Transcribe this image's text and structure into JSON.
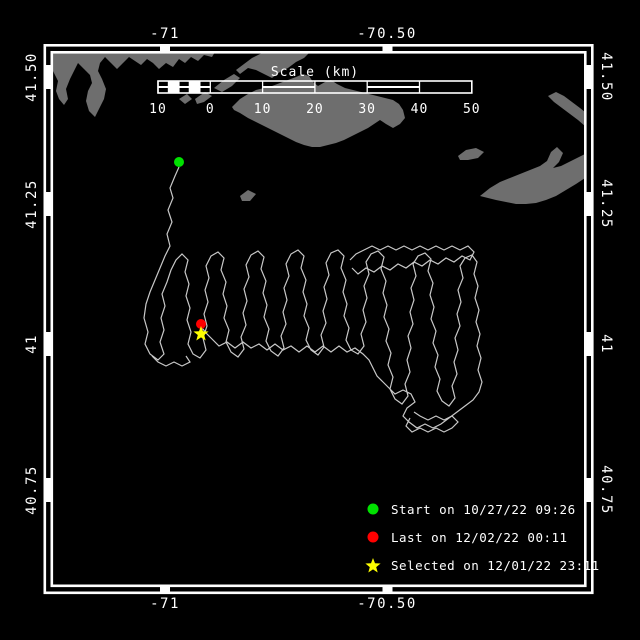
{
  "colors": {
    "background": "#000000",
    "frame": "#ffffff",
    "land": "#6e6e6e",
    "track": "#c8c8c8",
    "start": "#00e100",
    "last": "#ff0000",
    "selected": "#ffff00",
    "text": "#ffffff"
  },
  "axes": {
    "top": [
      "-71",
      "-70.50"
    ],
    "bottom": [
      "-71",
      "-70.50"
    ],
    "left": [
      "41.50",
      "41.25",
      "41",
      "40.75"
    ],
    "right": [
      "41.50",
      "41.25",
      "41",
      "40.75"
    ]
  },
  "legend": {
    "items": [
      {
        "icon": "circle",
        "color": "#00e100",
        "label": "Start on 10/27/22 09:26"
      },
      {
        "icon": "circle",
        "color": "#ff0000",
        "label": "Last on 12/02/22 00:11"
      },
      {
        "icon": "star",
        "color": "#ffff00",
        "label": "Selected on 12/01/22 23:11"
      }
    ]
  },
  "map": {
    "frame": {
      "lon_tick_x": [
        165,
        387.5
      ],
      "lat_tick_y": [
        77,
        204,
        344,
        490
      ]
    },
    "scalebar": {
      "title": "Scale (km)",
      "x0": 158,
      "y0": 81,
      "height": 12,
      "px_per_km": 5.23,
      "km_min": -10,
      "title_x": 315,
      "title_y": 76,
      "labels_y": 113,
      "segments": [
        [
          -10,
          -8,
          "mid"
        ],
        [
          -8,
          -6,
          "solid"
        ],
        [
          -6,
          -4,
          "mid"
        ],
        [
          -4,
          -2,
          "solid"
        ],
        [
          -2,
          0,
          "mid"
        ],
        [
          0,
          10,
          "open"
        ],
        [
          10,
          20,
          "mid"
        ],
        [
          20,
          30,
          "open"
        ],
        [
          30,
          40,
          "mid"
        ],
        [
          40,
          50,
          "open"
        ]
      ],
      "ticks": [
        [
          -10,
          "10"
        ],
        [
          0,
          "0"
        ],
        [
          10,
          "10"
        ],
        [
          20,
          "20"
        ],
        [
          30,
          "30"
        ],
        [
          40,
          "40"
        ],
        [
          50,
          "50"
        ]
      ]
    },
    "land": [
      [
        52,
        52,
        215,
        52,
        212,
        57,
        204,
        55,
        198,
        61,
        191,
        57,
        185,
        63,
        179,
        59,
        173,
        67,
        166,
        63,
        159,
        69,
        153,
        63,
        147,
        59,
        141,
        65,
        135,
        61,
        129,
        57,
        123,
        63,
        117,
        69,
        111,
        63,
        105,
        57,
        100,
        63,
        98,
        71,
        102,
        79,
        106,
        89,
        104,
        99,
        99,
        109,
        95,
        117,
        89,
        111,
        86,
        101,
        88,
        91,
        92,
        83,
        90,
        75,
        84,
        69,
        78,
        63,
        74,
        71,
        70,
        79,
        66,
        89,
        68,
        99,
        64,
        105,
        59,
        99,
        56,
        91,
        58,
        81,
        54,
        73,
        52,
        69
      ],
      [
        236,
        70,
        244,
        64,
        252,
        58,
        262,
        53,
        310,
        52,
        304,
        58,
        296,
        62,
        288,
        68,
        280,
        72,
        272,
        78,
        264,
        74,
        256,
        70,
        248,
        68,
        240,
        74
      ],
      [
        214,
        88,
        224,
        80,
        234,
        74,
        240,
        78,
        232,
        86,
        222,
        92
      ],
      [
        195,
        99,
        205,
        92,
        212,
        96,
        204,
        102,
        197,
        104
      ],
      [
        179,
        99,
        187,
        94,
        192,
        99,
        185,
        104
      ],
      [
        232,
        107,
        240,
        99,
        248,
        94,
        256,
        90,
        264,
        88,
        272,
        86,
        280,
        83,
        288,
        80,
        296,
        77,
        303,
        74,
        309,
        76,
        313,
        82,
        318,
        86,
        325,
        82,
        331,
        80,
        337,
        84,
        345,
        88,
        353,
        90,
        361,
        92,
        369,
        94,
        377,
        96,
        385,
        98,
        393,
        100,
        399,
        104,
        403,
        110,
        405,
        118,
        400,
        124,
        393,
        128,
        386,
        124,
        380,
        120,
        374,
        124,
        368,
        128,
        360,
        132,
        352,
        136,
        344,
        140,
        336,
        143,
        328,
        145,
        320,
        147,
        312,
        147,
        304,
        145,
        296,
        142,
        288,
        138,
        280,
        134,
        272,
        130,
        264,
        126,
        256,
        122,
        248,
        118,
        240,
        113,
        234,
        110
      ],
      [
        240,
        196,
        248,
        190,
        256,
        194,
        250,
        201,
        242,
        201
      ],
      [
        458,
        156,
        466,
        150,
        476,
        148,
        484,
        152,
        478,
        158,
        468,
        160,
        460,
        160
      ],
      [
        480,
        196,
        490,
        188,
        500,
        182,
        510,
        178,
        520,
        174,
        530,
        170,
        540,
        166,
        547,
        161,
        551,
        152,
        557,
        147,
        563,
        153,
        559,
        162,
        553,
        168,
        561,
        166,
        569,
        162,
        577,
        158,
        585,
        154,
        585,
        178,
        576,
        184,
        566,
        190,
        556,
        196,
        546,
        200,
        536,
        203,
        526,
        204,
        516,
        204,
        506,
        202,
        496,
        200,
        488,
        198
      ],
      [
        548,
        96,
        556,
        92,
        564,
        96,
        572,
        102,
        580,
        108,
        585,
        112,
        585,
        126,
        578,
        120,
        570,
        114,
        562,
        108,
        554,
        102
      ]
    ],
    "tracks": [
      [
        179,
        167,
        175,
        176,
        170,
        188,
        173,
        198,
        168,
        210,
        172,
        222,
        167,
        234,
        170,
        246,
        165,
        256,
        160,
        268,
        155,
        280,
        150,
        292,
        146,
        304,
        144,
        318,
        148,
        332,
        145,
        344,
        150,
        354,
        158,
        360,
        164,
        354,
        160,
        342,
        164,
        330,
        161,
        318,
        165,
        306,
        162,
        294,
        167,
        282,
        171,
        270,
        176,
        260,
        182,
        254,
        188,
        260,
        185,
        272,
        189,
        284,
        186,
        296,
        190,
        308,
        187,
        320,
        191,
        332,
        188,
        344,
        193,
        354,
        200,
        358,
        206,
        350,
        203,
        338,
        207,
        326,
        204,
        314,
        208,
        302,
        205,
        290,
        209,
        278,
        206,
        266,
        211,
        256,
        218,
        252,
        224,
        258,
        221,
        270,
        226,
        282,
        223,
        294,
        227,
        306,
        224,
        318,
        229,
        330,
        226,
        342,
        231,
        352,
        238,
        357,
        244,
        349,
        241,
        337,
        246,
        325,
        243,
        313,
        247,
        301,
        244,
        289,
        249,
        277,
        246,
        265,
        251,
        255,
        258,
        251,
        264,
        257,
        261,
        269,
        266,
        281,
        263,
        293,
        267,
        305,
        264,
        317,
        269,
        329,
        266,
        341,
        271,
        351,
        278,
        356,
        284,
        348,
        281,
        336,
        286,
        324,
        283,
        312,
        287,
        300,
        284,
        288,
        289,
        276,
        286,
        264,
        291,
        254,
        298,
        250,
        304,
        256,
        301,
        268,
        306,
        280,
        303,
        292,
        307,
        304,
        304,
        316,
        309,
        328,
        306,
        340,
        311,
        350,
        318,
        355,
        324,
        347,
        321,
        335,
        326,
        323,
        323,
        311,
        327,
        299,
        324,
        287,
        329,
        275,
        326,
        263,
        331,
        253,
        338,
        250,
        344,
        256,
        341,
        268,
        346,
        280,
        343,
        292,
        347,
        304,
        344,
        316,
        349,
        328,
        346,
        340,
        351,
        350,
        358,
        354,
        364,
        346,
        361,
        334,
        366,
        322,
        363,
        310,
        367,
        298,
        364,
        286,
        369,
        274,
        366,
        262,
        371,
        254,
        378,
        251,
        384,
        257,
        381,
        269,
        386,
        281,
        383,
        293,
        387,
        305,
        384,
        317,
        389,
        329,
        386,
        341,
        391,
        353,
        388,
        365,
        393,
        377,
        390,
        389,
        395,
        399,
        402,
        404,
        408,
        396,
        405,
        384,
        410,
        372,
        407,
        360,
        411,
        348,
        408,
        336,
        413,
        324,
        410,
        312,
        414,
        300,
        411,
        288,
        416,
        276,
        413,
        264,
        418,
        256,
        425,
        253,
        431,
        259,
        428,
        271,
        433,
        283,
        430,
        295,
        434,
        307,
        431,
        319,
        436,
        331,
        433,
        343,
        438,
        355,
        435,
        367,
        440,
        379,
        437,
        391,
        442,
        401,
        449,
        406,
        455,
        398,
        452,
        386,
        457,
        374,
        454,
        362,
        458,
        350,
        455,
        338,
        460,
        326,
        457,
        314,
        461,
        302,
        458,
        290,
        463,
        278,
        460,
        266,
        465,
        258,
        472,
        255,
        477,
        262,
        474,
        274,
        478,
        286,
        475,
        298,
        479,
        310,
        476,
        322,
        480,
        334,
        477,
        346,
        481,
        358,
        478,
        370,
        482,
        382,
        479,
        392,
        473,
        400,
        465,
        406,
        457,
        412,
        449,
        418,
        441,
        424,
        433,
        428,
        425,
        424,
        417,
        428,
        409,
        422,
        403,
        416,
        407,
        408,
        415,
        402,
        411,
        394,
        403,
        390,
        395,
        394,
        389,
        388,
        383,
        382,
        377,
        376,
        373,
        368,
        369,
        360,
        363,
        354,
        355,
        348,
        347,
        352,
        339,
        346,
        331,
        352,
        323,
        346,
        315,
        352,
        307,
        346,
        299,
        352,
        291,
        346,
        283,
        350,
        275,
        344,
        267,
        350,
        259,
        344,
        251,
        348,
        243,
        342,
        235,
        348,
        227,
        342,
        219,
        346,
        213,
        340,
        207,
        334,
        202,
        328,
        201,
        325
      ],
      [
        350,
        260,
        356,
        254,
        364,
        250,
        372,
        246,
        380,
        250,
        388,
        246,
        396,
        250,
        404,
        246,
        412,
        250,
        420,
        246,
        428,
        250,
        436,
        246,
        444,
        250,
        452,
        246,
        460,
        250,
        468,
        246,
        474,
        252,
        470,
        260,
        462,
        256,
        454,
        262,
        446,
        258,
        438,
        264,
        430,
        260,
        422,
        266,
        414,
        262,
        406,
        268,
        398,
        264,
        390,
        270,
        382,
        266,
        374,
        272,
        366,
        268,
        358,
        274,
        352,
        268
      ],
      [
        410,
        418,
        406,
        426,
        412,
        432,
        420,
        428,
        428,
        432,
        436,
        428,
        444,
        432,
        452,
        428,
        458,
        422,
        452,
        416,
        444,
        420,
        436,
        416,
        428,
        420,
        420,
        416,
        414,
        412
      ],
      [
        152,
        356,
        158,
        362,
        166,
        366,
        174,
        362,
        182,
        366,
        190,
        362,
        186,
        356
      ]
    ],
    "markers": [
      {
        "name": "start-marker",
        "type": "circle",
        "x": 179,
        "y": 162,
        "r": 5,
        "color": "#00e100"
      },
      {
        "name": "last-marker",
        "type": "circle",
        "x": 201,
        "y": 324,
        "r": 5,
        "color": "#ff0000"
      },
      {
        "name": "selected-marker",
        "type": "star",
        "x": 201,
        "y": 334,
        "r": 8,
        "color": "#ffff00"
      }
    ]
  }
}
